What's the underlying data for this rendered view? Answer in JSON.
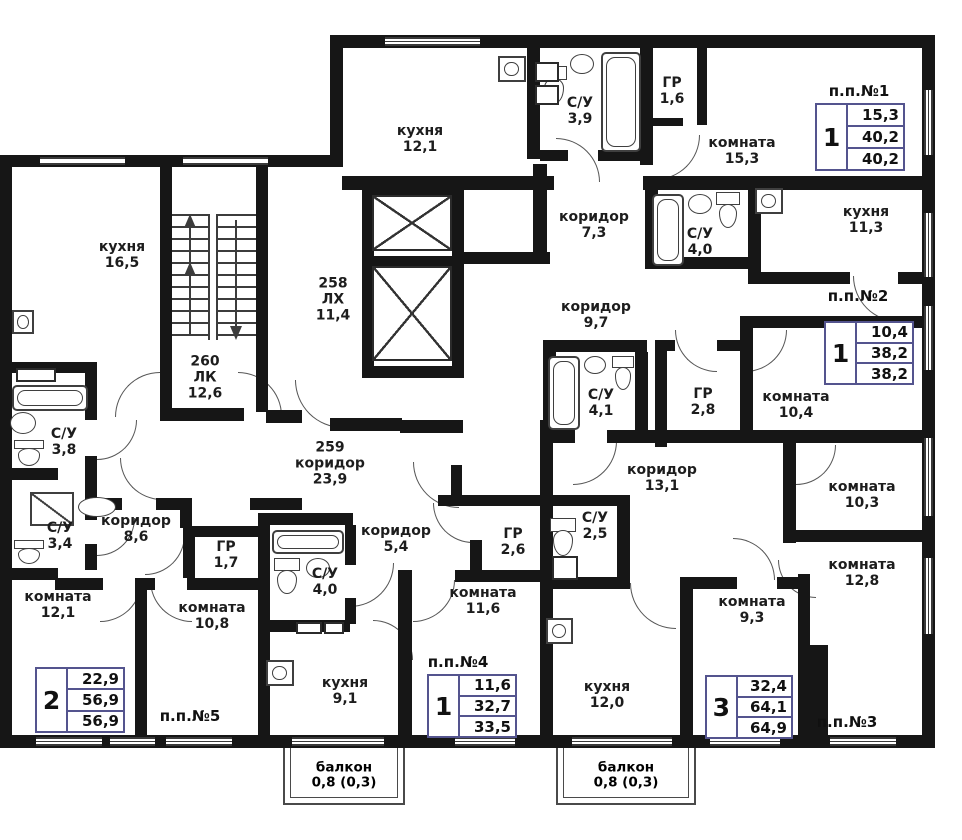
{
  "units": [
    {
      "name": "п.п.№1",
      "rooms_count": "1",
      "rows": [
        "15,3",
        "40,2",
        "40,2"
      ]
    },
    {
      "name": "п.п.№2",
      "rooms_count": "1",
      "rows": [
        "10,4",
        "38,2",
        "38,2"
      ]
    },
    {
      "name": "п.п.№3",
      "rooms_count": "3",
      "rows": [
        "32,4",
        "64,1",
        "64,9"
      ]
    },
    {
      "name": "п.п.№4",
      "rooms_count": "1",
      "rows": [
        "11,6",
        "32,7",
        "33,5"
      ]
    },
    {
      "name": "п.п.№5",
      "rooms_count": "2",
      "rows": [
        "22,9",
        "56,9",
        "56,9"
      ]
    }
  ],
  "core": {
    "stairs": {
      "number": "260",
      "label": "ЛК",
      "area": "12,6"
    },
    "elevator_hall": {
      "number": "258",
      "label": "ЛХ",
      "area": "11,4"
    },
    "corridor": {
      "number": "259",
      "label": "коридор",
      "area": "23,9"
    }
  },
  "rooms": [
    {
      "label": "кухня",
      "area": "12,1"
    },
    {
      "label": "С/У",
      "area": "3,9"
    },
    {
      "label": "ГР",
      "area": "1,6"
    },
    {
      "label": "комната",
      "area": "15,3"
    },
    {
      "label": "коридор",
      "area": "7,3"
    },
    {
      "label": "С/У",
      "area": "4,0"
    },
    {
      "label": "кухня",
      "area": "11,3"
    },
    {
      "label": "коридор",
      "area": "9,7"
    },
    {
      "label": "С/У",
      "area": "4,1"
    },
    {
      "label": "ГР",
      "area": "2,8"
    },
    {
      "label": "комната",
      "area": "10,4"
    },
    {
      "label": "кухня",
      "area": "16,5"
    },
    {
      "label": "С/У",
      "area": "3,8"
    },
    {
      "label": "С/У",
      "area": "3,4"
    },
    {
      "label": "коридор",
      "area": "8,6"
    },
    {
      "label": "ГР",
      "area": "1,7"
    },
    {
      "label": "комната",
      "area": "12,1"
    },
    {
      "label": "комната",
      "area": "10,8"
    },
    {
      "label": "коридор",
      "area": "5,4"
    },
    {
      "label": "С/У",
      "area": "4,0"
    },
    {
      "label": "ГР",
      "area": "2,6"
    },
    {
      "label": "комната",
      "area": "11,6"
    },
    {
      "label": "кухня",
      "area": "9,1"
    },
    {
      "label": "коридор",
      "area": "13,1"
    },
    {
      "label": "С/У",
      "area": "2,5"
    },
    {
      "label": "кухня",
      "area": "12,0"
    },
    {
      "label": "комната",
      "area": "9,3"
    },
    {
      "label": "комната",
      "area": "10,3"
    },
    {
      "label": "комната",
      "area": "12,8"
    }
  ],
  "balconies": [
    {
      "label": "балкон",
      "area": "0,8 (0,3)"
    },
    {
      "label": "балкон",
      "area": "0,8 (0,3)"
    }
  ]
}
